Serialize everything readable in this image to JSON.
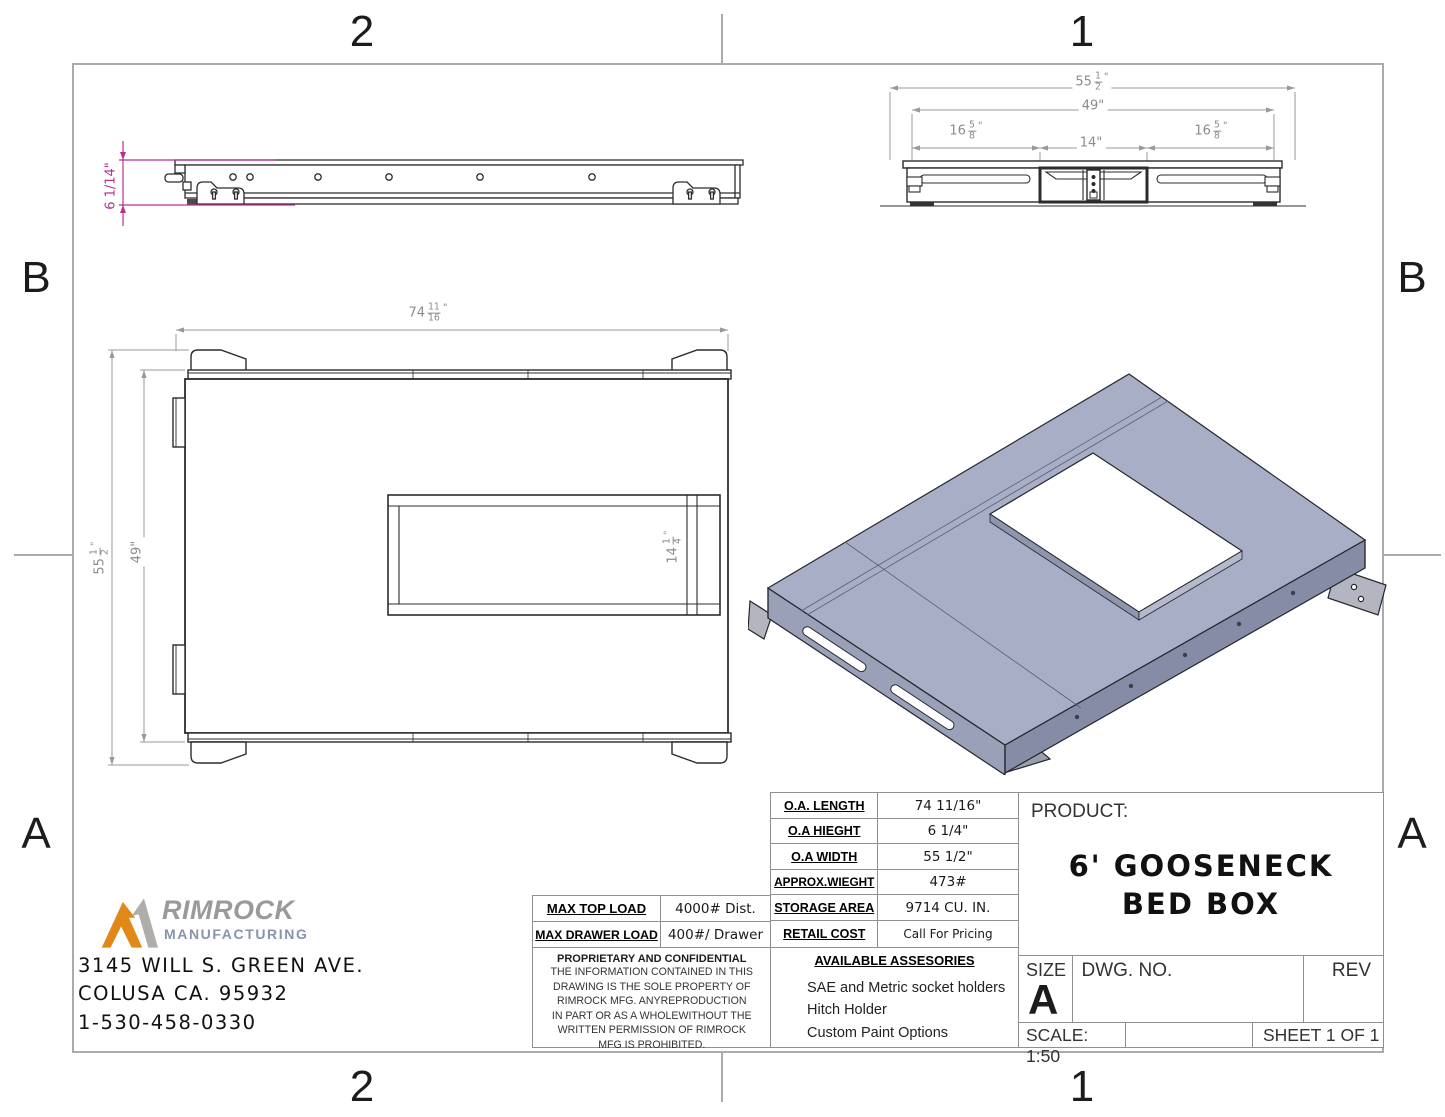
{
  "frame": {
    "zone_top_left": "2",
    "zone_top_right": "1",
    "zone_bottom_left": "2",
    "zone_bottom_right": "1",
    "zone_left_upper": "B",
    "zone_left_lower": "A",
    "zone_right_upper": "B",
    "zone_right_lower": "A"
  },
  "dims": {
    "side_height": "6 1/14\"",
    "front_overall": {
      "whole": "55",
      "num": "1",
      "den": "2",
      "unit": "\""
    },
    "front_inner": "49\"",
    "front_left": {
      "whole": "16",
      "num": "5",
      "den": "8",
      "unit": "\""
    },
    "front_center": "14\"",
    "front_right": {
      "whole": "16",
      "num": "5",
      "den": "8",
      "unit": "\""
    },
    "plan_length": {
      "whole": "74",
      "num": "11",
      "den": "16",
      "unit": "\""
    },
    "plan_width": {
      "whole": "55",
      "num": "1",
      "den": "2",
      "unit": "\""
    },
    "plan_inner": "49\"",
    "plan_opening": {
      "whole": "14",
      "num": "1",
      "den": "4",
      "unit": "\""
    }
  },
  "logo": {
    "name": "RIMROCK",
    "subtitle": "MANUFACTURING"
  },
  "company": {
    "address1": "3145 WILL S. GREEN AVE.",
    "address2": "COLUSA CA. 95932",
    "phone": "1-530-458-0330"
  },
  "load_table": {
    "rows": [
      {
        "label": "MAX TOP LOAD",
        "value": "4000# Dist."
      },
      {
        "label": "MAX DRAWER LOAD",
        "value": "400#/ Drawer"
      }
    ]
  },
  "proprietary": {
    "title": "PROPRIETARY AND CONFIDENTIAL",
    "lines": [
      "THE INFORMATION CONTAINED IN THIS",
      "DRAWING IS THE SOLE PROPERTY OF",
      "RIMROCK MFG.  ANYREPRODUCTION",
      "IN PART OR AS A WHOLEWITHOUT THE",
      "WRITTEN PERMISSION OF RIMROCK",
      "MFG IS PROHIBITED."
    ]
  },
  "specs": {
    "rows": [
      {
        "label": "O.A. LENGTH",
        "value": "74 11/16\""
      },
      {
        "label": "O.A HIEGHT",
        "value": "6 1/4\""
      },
      {
        "label": "O.A WIDTH",
        "value": "55 1/2\""
      },
      {
        "label": "APPROX.WIEGHT",
        "value": "473#"
      },
      {
        "label": "STORAGE AREA",
        "value": "9714 CU. IN."
      },
      {
        "label": "RETAIL COST",
        "value": "Call For Pricing"
      }
    ]
  },
  "accessories": {
    "title": "AVAILABLE ASSESORIES",
    "items": [
      "SAE and Metric socket holders",
      "Hitch Holder",
      "Custom Paint Options"
    ]
  },
  "title_block": {
    "product_label": "PRODUCT:",
    "product_line1": "6' GOOSENECK",
    "product_line2": "BED BOX",
    "size_label": "SIZE",
    "size_value": "A",
    "dwg_label": "DWG.  NO.",
    "rev_label": "REV",
    "scale": "SCALE: 1:50",
    "sheet": "SHEET 1 OF 1"
  },
  "colors": {
    "accent_magenta": "#b5338f",
    "logo_orange": "#e08818",
    "logo_gray": "#9a9a99",
    "logo_steel": "#8894ab",
    "model_top": "#a8aec5",
    "model_side_left": "#99a0b7",
    "model_side_right": "#868ca5",
    "line": "#2c2c2c",
    "border_gray": "#ababab"
  }
}
